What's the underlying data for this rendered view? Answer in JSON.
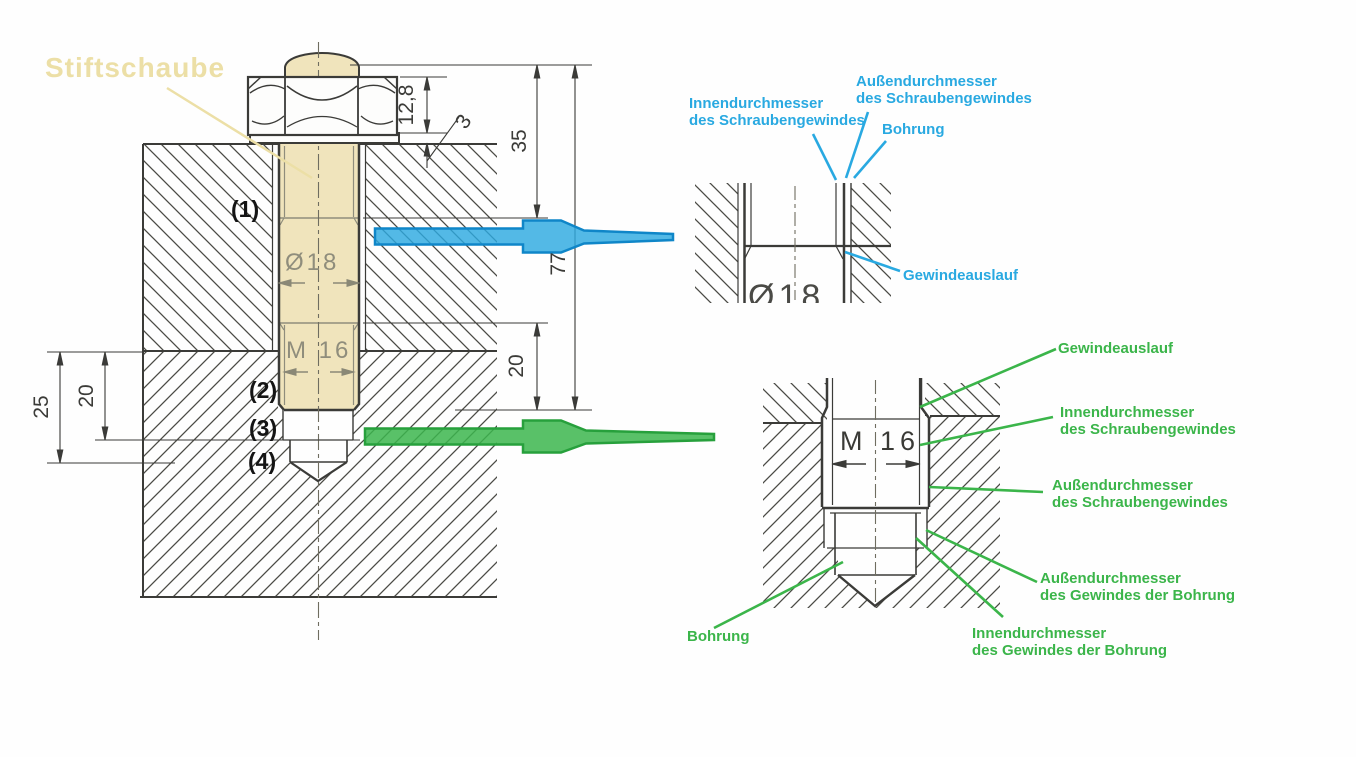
{
  "callout": {
    "stud_label": "Stiftschaube"
  },
  "part_markers": {
    "m1": "(1)",
    "m2": "(2)",
    "m3": "(3)",
    "m4": "(4)"
  },
  "dimensions": {
    "nut_height": "12,8",
    "washer_thickness": "3",
    "upper_thread_length": "35",
    "total_length": "77",
    "lower_thread_length": "20",
    "bore_thread_depth": "20",
    "bore_depth": "25",
    "shank_diameter": "Ø18",
    "thread_size": "M 16"
  },
  "detail_blue": {
    "labels": {
      "inner_dia": "Innendurchmesser\ndes Schraubengewindes",
      "outer_dia": "Außendurchmesser\ndes Schraubengewindes",
      "bore": "Bohrung",
      "runout": "Gewindeauslauf"
    },
    "magnified_text": "Ø18"
  },
  "detail_green": {
    "labels": {
      "runout": "Gewindeauslauf",
      "screw_inner": "Innendurchmesser\ndes Schraubengewindes",
      "screw_outer": "Außendurchmesser\ndes Schraubengewindes",
      "bore_thread_outer": "Außendurchmesser\ndes Gewindes der Bohrung",
      "bore_thread_inner": "Innendurchmesser\ndes Gewindes der Bohrung",
      "bore": "Bohrung"
    },
    "thread_text": "M 16"
  },
  "colors": {
    "blue": "#29a9e1",
    "green": "#3bb54a",
    "beige": "#f0e4bc",
    "line": "#3b3b38"
  }
}
